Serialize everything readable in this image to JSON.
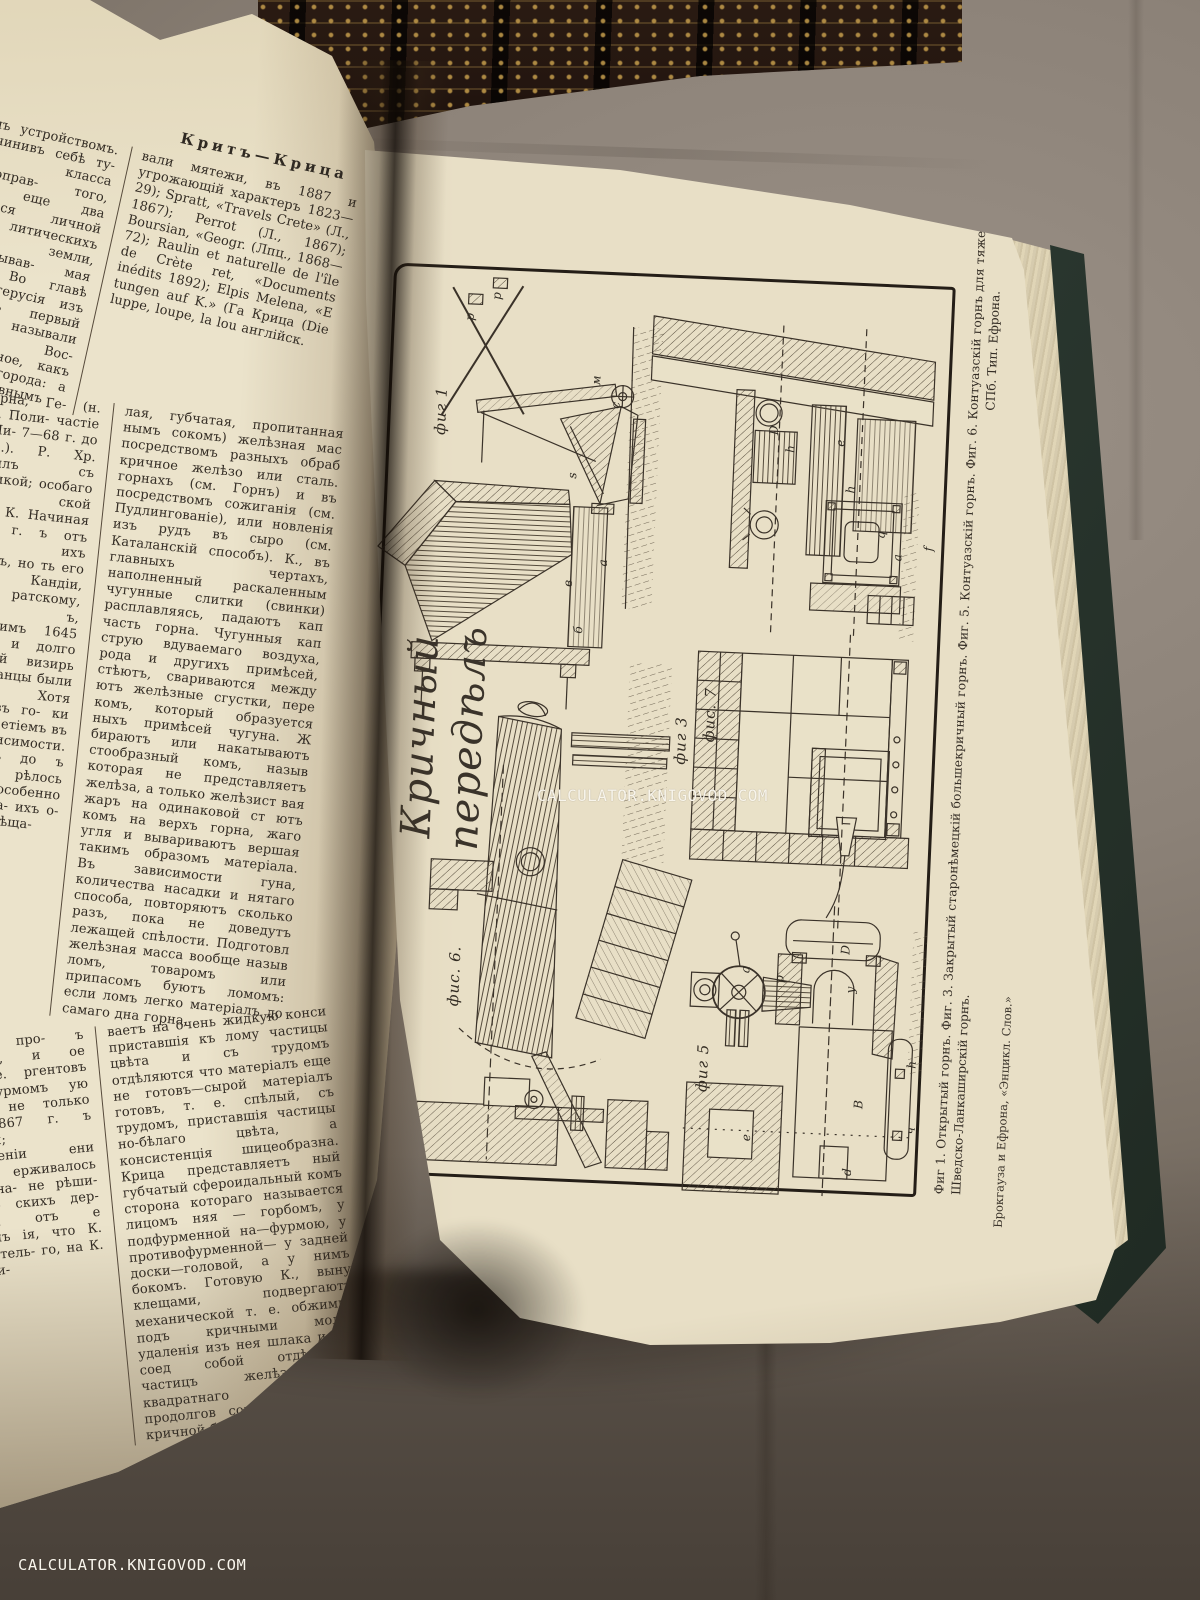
{
  "watermarks": {
    "center": "CALCULATOR.KNIGOVOD.COM",
    "bottom_left": "CALCULATOR.KNIGOVOD.COM"
  },
  "left_page": {
    "header": "Критъ—Крица",
    "column1_lines": [
      "щимъ устройствомъ.",
      "Подчинивъ себѣ ту-",
      "го класса полноправ-",
      "того, было еще два",
      "вавшіеся личной сво-",
      "литическихъ правъ,",
      "земли, обработывав-",
      "мая земли. Во главѣ",
      "формъ герусія изъ 30",
      "ихъ первый назыв.",
      "называли годъ. Вос-",
      "общественное, какъ",
      "ительные города:",
      "а съ баснословнымъ",
      "Елеутерна, Ге-",
      "(н. Канея), Поли-",
      "частіе К. въ Ми-",
      "7—68 г. до Р. Хр.).",
      "Р. Хр. соединилъ",
      "съ Киренаикой;",
      "особаго намѣст-",
      "ской имперіи К.",
      "Начиная съ 650 г.",
      "ъ отъ набѣговъ",
      "ихъ островомъ, но",
      "ть его Византіи.",
      "Кандіи, достался",
      "ратскому, кото-",
      "ъ, удержавшимъ",
      "1645 г. турки",
      "и долго тщетно",
      "ій визирь Кеп-",
      "енеціанцы были",
      "упадокъ. Хотя",
      "ольности въ го-",
      "ки изгнать ту-",
      "етіемъ въ воз-",
      "независимости.",
      "адѣлъ имъ до",
      "ъ возвратить",
      "рѣлось новое",
      "омъ, особенно",
      "успокоить на-",
      "ихъ о-въ къ",
      "а К. Обѣща-",
      "селеніе про-",
      "ъ налоговъ, и",
      "ое возстаніе.",
      "ргентовъ на",
      "штурмомъ",
      "ую минуту",
      "не только",
      "алѣ 1867 г.",
      "ъ турками;",
      "учрежденіи",
      "ени короля",
      "ерживалось",
      "пока, на-",
      "не рѣши-",
      "собрав-",
      "скихъ дер-",
      "жаться отъ",
      "е критянъ",
      "ія, что К.",
      "состоятель-",
      "го, на К.",
      "вспыхи-"
    ],
    "column2_lines": [
      "вали мятежи, въ 1887 и",
      "угрожающій характеръ",
      "1823—29); Spratt, «Travels",
      "Crete» (Л., 1867); Perrot",
      "(Л., 1867); Boursian, «Geogr.",
      "(Лпц., 1868—72); Raulin",
      "et naturelle de l'île de Crète",
      "ret, «Documents inédits",
      "1892); Elpis Melena, «E",
      "tungen auf K.» (Га",
      "Крица (Die luppe, loupe, la lou",
      "англійск.",
      "лая, губчатая, пропитанная",
      "нымъ сокомъ) желѣзная мас",
      "посредствомъ разныхъ обраб",
      "кричное желѣзо или сталь.",
      "горнахъ (см. Горнъ) и въ",
      "посредствомъ сожиганія",
      "(см. Пудлингованіе), или",
      "новленія изъ рудъ въ сыро",
      "(см. Каталанскій способъ).",
      "К., въ главныхъ чертахъ,",
      "наполненный раскаленным",
      "чугунные слитки (свинки)",
      "расплавляясь, падаютъ кап",
      "часть горна. Чугунныя кап",
      "струю вдуваемаго воздуха,",
      "рода и другихъ примѣсей,",
      "стѣютъ, свариваются между",
      "ютъ желѣзные сгустки, пере",
      "комъ, который образуется",
      "ныхъ примѣсей чугуна. Ж",
      "бираютъ или накатываютъ",
      "стообразный комъ, назыв",
      "которая не представляетъ",
      "желѣза, а только желѣзист",
      "вая жаръ на одинаковой ст",
      "ютъ комъ на верхъ горна,",
      "жаго угля и вывариваютъ",
      "вершая такимъ образомъ",
      "матеріала. Въ зависимости",
      "гуна, количества насадки и",
      "нятаго способа, повторяютъ",
      "сколько разъ, пока не доведутъ",
      "лежащей спѣлости. Подготовл",
      "желѣзная масса вообще назыв",
      "ломъ, товаромъ или припасомъ",
      "буютъ ломомъ: если ломъ легко",
      "матеріалъ до самаго дна горна,",
      "ваетъ на очень жидкую конси",
      "приставшія къ лому частицы",
      "цвѣта и съ трудомъ отдѣляются",
      "что матеріалъ еще не готовъ—сырой",
      "матеріалъ готовъ, т. е. спѣлый,",
      "съ трудомъ, приставшія частицы",
      "но-бѣлаго цвѣта, а консистенція",
      "шицеобразна. Крица представляетъ",
      "ный губчатый сфероидальный комъ",
      "сторона котораго называется лицомъ",
      "няя — горбомъ, у подфурменной",
      "на—фурмою, у противофурменной—",
      "у задней доски—головой, а у",
      "нимъ бокомъ. Готовую К., выну",
      "клещами, подвергаютъ механической",
      "т. е. обжимкѣ подъ кричными молот",
      "удаленія изъ нея шлака и для соед",
      "собой отдѣльныхъ частицъ желѣз",
      "ютъ квадратнаго сѣченія продолгов",
      "сокъ, называемый кричной болванкой"
    ]
  },
  "plate_page": {
    "script_title": "Кричный передѣлъ",
    "figure_labels": {
      "fig1": "фиг 1",
      "fig7": "фис. 7",
      "fig3": "фиг 3",
      "fig6": "фис. 6.",
      "fig5": "фиг 5"
    },
    "figure_letters": [
      {
        "t": "p",
        "x": 86,
        "y": 60
      },
      {
        "t": "p",
        "x": 112,
        "y": 38
      },
      {
        "t": "м",
        "x": 214,
        "y": 118
      },
      {
        "t": "с",
        "x": 236,
        "y": 142
      },
      {
        "t": "s",
        "x": 196,
        "y": 214
      },
      {
        "t": "в",
        "x": 196,
        "y": 322
      },
      {
        "t": "a",
        "x": 230,
        "y": 300
      },
      {
        "t": "б",
        "x": 208,
        "y": 368
      },
      {
        "t": "D",
        "x": 394,
        "y": 160
      },
      {
        "t": "h",
        "x": 412,
        "y": 178
      },
      {
        "t": "e",
        "x": 462,
        "y": 170
      },
      {
        "t": "h",
        "x": 474,
        "y": 216
      },
      {
        "t": "q",
        "x": 506,
        "y": 260
      },
      {
        "t": "a",
        "x": 524,
        "y": 282
      },
      {
        "t": "f",
        "x": 556,
        "y": 272
      },
      {
        "t": "a",
        "x": 390,
        "y": 700
      },
      {
        "t": "p",
        "x": 424,
        "y": 708
      },
      {
        "t": "D",
        "x": 488,
        "y": 676
      },
      {
        "t": "y",
        "x": 496,
        "y": 716
      },
      {
        "t": "B",
        "x": 508,
        "y": 830
      },
      {
        "t": "e",
        "x": 398,
        "y": 868
      },
      {
        "t": "h",
        "x": 560,
        "y": 788
      },
      {
        "t": "ч",
        "x": 562,
        "y": 854
      },
      {
        "t": "d",
        "x": 500,
        "y": 898
      }
    ],
    "caption_line1": "Фиг 1. Открытый горнъ.   Фиг. 3. Закрытый старонѣмецкій большекричный горнъ.   Фиг. 5. Контуазскій горнъ.   Фиг. 6. Контуазскій горнъ для тяжеловѣсныхъ вещей.   Фиг. 7",
    "caption_line2": "Шведско-Ланкаширскій горнъ.",
    "imprint": "СПб. Тип. Ефрона.",
    "attribution": "Брокгауза и Ефрона, «Энцикл. Слов.»"
  },
  "colors": {
    "fabric": "#8b8177",
    "paper_left": "#ebe3cb",
    "paper_plate": "#e8dfc6",
    "ink": "#342d25",
    "cover_green": "#2b3830",
    "spine_gold": "#b08d48",
    "watermark": "#f8f5ec"
  }
}
